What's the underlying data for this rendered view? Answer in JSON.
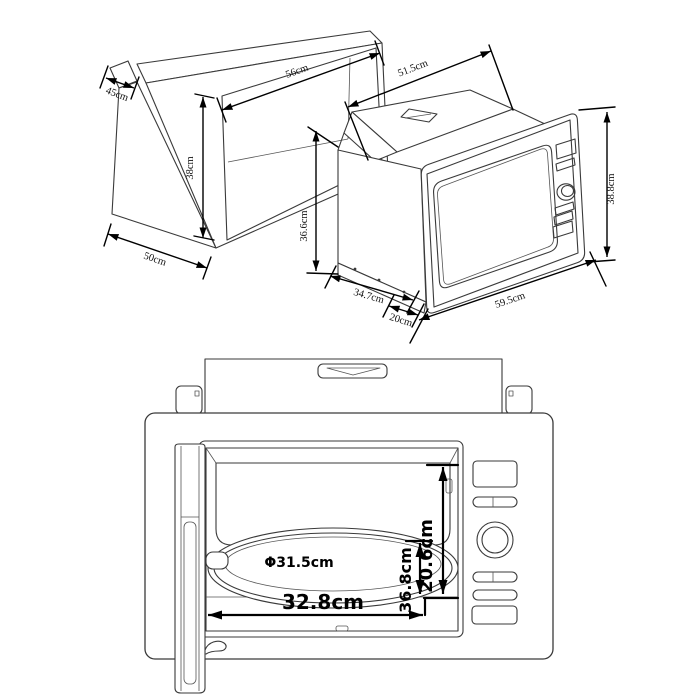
{
  "diagram_title": "Built-in microwave installation dimensions",
  "colors": {
    "background": "#ffffff",
    "object_line": "#3a3a3a",
    "dimension_line": "#000000"
  },
  "isometric_view": {
    "cabinet": {
      "name": "cabinet niche",
      "dimensions": {
        "top_depth": "45cm",
        "width": "56cm",
        "height": "38cm",
        "bottom_depth": "50cm"
      }
    },
    "microwave": {
      "name": "built-in microwave oven",
      "dimensions": {
        "depth": "51.5cm",
        "body_height": "36.6cm",
        "body_width": "34.7cm",
        "trim_depth": "20cm",
        "front_width": "59.5cm",
        "front_height": "38.8cm"
      }
    }
  },
  "front_view": {
    "name": "installed microwave front view",
    "dimensions": {
      "cavity_height": "20.6cm",
      "cavity_depth": "36.8cm",
      "turntable_diameter": "Φ31.5cm",
      "cavity_width": "32.8cm"
    }
  }
}
